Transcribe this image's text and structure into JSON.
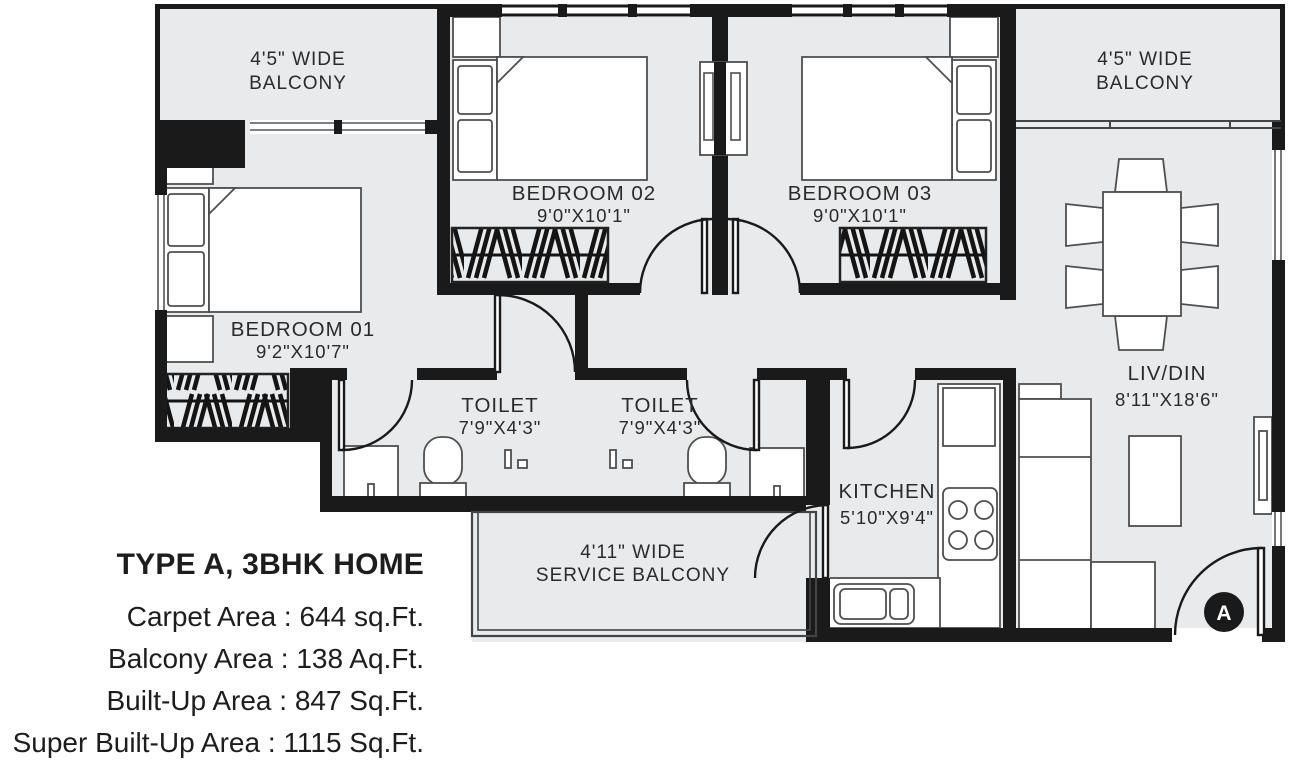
{
  "info": {
    "title": "TYPE A, 3BHK HOME",
    "separator": " : ",
    "areas": [
      {
        "label": "Carpet Area",
        "value": "644 sq.Ft."
      },
      {
        "label": "Balcony Area",
        "value": "138 Aq.Ft."
      },
      {
        "label": "Built-Up Area",
        "value": "847 Sq.Ft."
      },
      {
        "label": "Super Built-Up Area",
        "value": "1115 Sq.Ft."
      }
    ]
  },
  "rooms": {
    "balcony_left": {
      "line1": "4'5\" WIDE",
      "line2": "BALCONY"
    },
    "balcony_right": {
      "line1": "4'5\" WIDE",
      "line2": "BALCONY"
    },
    "bedroom_02": {
      "name": "BEDROOM 02",
      "size": "9'0\"X10'1\""
    },
    "bedroom_03": {
      "name": "BEDROOM 03",
      "size": "9'0\"X10'1\""
    },
    "bedroom_01": {
      "name": "BEDROOM 01",
      "size": "9'2\"X10'7\""
    },
    "toilet_1": {
      "name": "TOILET",
      "size": "7'9\"X4'3\""
    },
    "toilet_2": {
      "name": "TOILET",
      "size": "7'9\"X4'3\""
    },
    "kitchen": {
      "name": "KITCHEN",
      "size": "5'10\"X9'4\""
    },
    "liv_din": {
      "name": "LIV/DIN",
      "size": "8'11\"X18'6\""
    },
    "service_balcony": {
      "line1": "4'11\" WIDE",
      "line2": "SERVICE BALCONY"
    }
  },
  "entrance": {
    "marker": "A"
  },
  "colors": {
    "wall": "#1a1a1a",
    "floor": "#e8eaec",
    "line": "#4f4f4f",
    "text": "#2a2a2a"
  }
}
